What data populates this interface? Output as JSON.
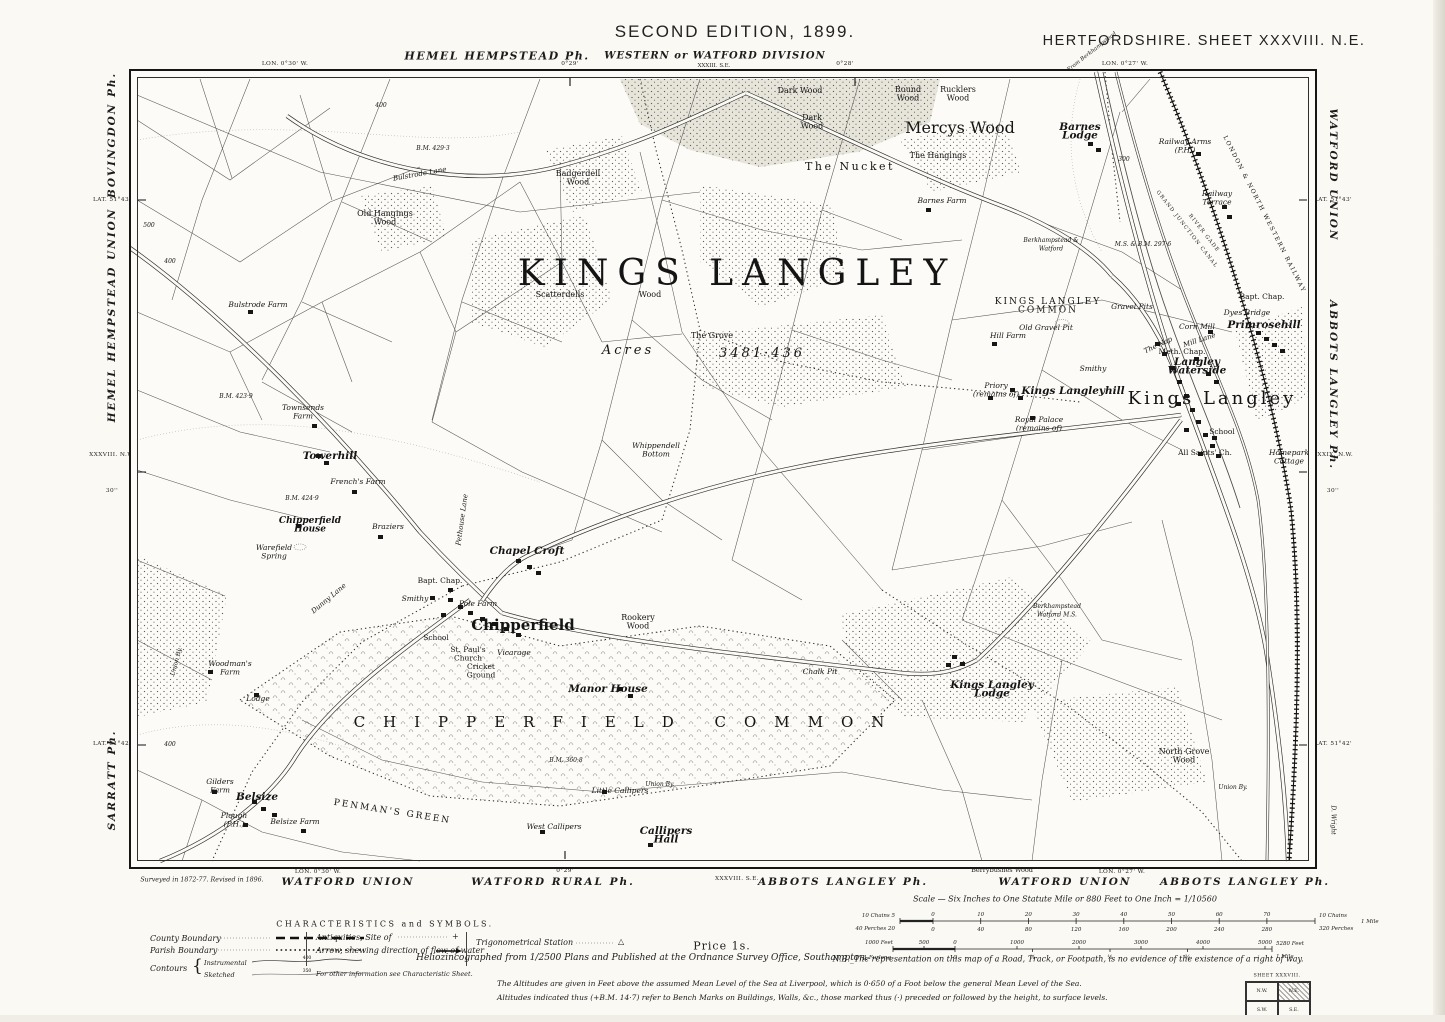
{
  "page": {
    "bg": "#faf9f4",
    "ink": "#1c1c1c"
  },
  "header": {
    "edition": "SECOND EDITION, 1899.",
    "sheet": "HERTFORDSHIRE.  SHEET XXXVIII. N.E.",
    "parish_top": "HEMEL HEMPSTEAD Ph.",
    "division": "WESTERN or WATFORD DIVISION",
    "division_sub": "XXXIII. S.E.",
    "from_note": "From Berkhampstead",
    "lon_marks": [
      {
        "text": "LON. 0°30' W.",
        "x": 285
      },
      {
        "text": "0°29'",
        "x": 570
      },
      {
        "text": "0°28'",
        "x": 845
      },
      {
        "text": "LON. 0°27' W.",
        "x": 1125
      }
    ]
  },
  "margin_left": [
    {
      "text": "BOVINGDON  Ph.",
      "y": 135,
      "cls": "par"
    },
    {
      "text": "LAT. 51°43'",
      "y": 200,
      "cls": "geo"
    },
    {
      "text": "HEMEL  HEMPSTEAD  UNION",
      "y": 315,
      "cls": "par"
    },
    {
      "text": "XXXVIII. N.W.",
      "y": 455,
      "cls": "geo"
    },
    {
      "text": "30''",
      "y": 491,
      "cls": "geo"
    },
    {
      "text": "LAT. 51°42'",
      "y": 744,
      "cls": "geo"
    },
    {
      "text": "SARRATT  Ph.",
      "y": 780,
      "cls": "par"
    }
  ],
  "margin_right": [
    {
      "text": "WATFORD  UNION",
      "y": 175,
      "cls": "par"
    },
    {
      "text": "LAT. 51°43'",
      "y": 200,
      "cls": "geo"
    },
    {
      "text": "ABBOTS  LANGLEY  Ph.",
      "y": 385,
      "cls": "par"
    },
    {
      "text": "XXXIX. N.W.",
      "y": 455,
      "cls": "geo"
    },
    {
      "text": "30''",
      "y": 491,
      "cls": "geo"
    },
    {
      "text": "D. Wright",
      "y": 820,
      "cls": "eng"
    },
    {
      "text": "LAT. 51°42'",
      "y": 744,
      "cls": "geo"
    }
  ],
  "margin_bottom": [
    {
      "text": "Surveyed in 1872-77.  Revised in 1896.",
      "x": 202,
      "y": 880,
      "cls": "tiny-i"
    },
    {
      "text": "LON. 0°30' W.",
      "x": 318,
      "y": 872,
      "cls": "geo"
    },
    {
      "text": "WATFORD  UNION",
      "x": 348,
      "y": 882,
      "cls": "par"
    },
    {
      "text": "0°29'",
      "x": 565,
      "y": 871,
      "cls": "geo"
    },
    {
      "text": "WATFORD  RURAL  Ph.",
      "x": 553,
      "y": 882,
      "cls": "par"
    },
    {
      "text": "XXXVIII. S.E.",
      "x": 737,
      "y": 879,
      "cls": "geo"
    },
    {
      "text": "ABBOTS  LANGLEY  Ph.",
      "x": 843,
      "y": 882,
      "cls": "par"
    },
    {
      "text": "Berrybushes  Wood",
      "x": 1002,
      "y": 870,
      "cls": "tiny-r"
    },
    {
      "text": "WATFORD  UNION",
      "x": 1065,
      "y": 882,
      "cls": "par"
    },
    {
      "text": "LON. 0°27' W.",
      "x": 1122,
      "y": 872,
      "cls": "geo"
    },
    {
      "text": "ABBOTS  LANGLEY  Ph.",
      "x": 1245,
      "y": 882,
      "cls": "par"
    }
  ],
  "map_labels": [
    {
      "t": "KINGS   LANGLEY",
      "x": 737,
      "y": 285,
      "c": "huge"
    },
    {
      "t": "Acres",
      "x": 628,
      "y": 354,
      "c": "acres"
    },
    {
      "t": "3481·436",
      "x": 762,
      "y": 357,
      "c": "acres"
    },
    {
      "t": "Scatterdells",
      "x": 560,
      "y": 297,
      "c": "wood"
    },
    {
      "t": "Wood",
      "x": 650,
      "y": 297,
      "c": "wood"
    },
    {
      "t": "The Grove",
      "x": 712,
      "y": 338,
      "c": "wood"
    },
    {
      "t": "Dark Wood",
      "x": 800,
      "y": 93,
      "c": "wood"
    },
    {
      "t": "Dark",
      "t2": "Wood",
      "x": 812,
      "y": 120,
      "c": "wood"
    },
    {
      "t": "Round",
      "t2": "Wood",
      "x": 908,
      "y": 92,
      "c": "wood"
    },
    {
      "t": "Rucklers",
      "t2": "Wood",
      "x": 958,
      "y": 92,
      "c": "wood"
    },
    {
      "t": "Mercys Wood",
      "x": 960,
      "y": 133,
      "c": "w ood"
    },
    {
      "t": "The Hangings",
      "x": 938,
      "y": 158,
      "c": "wood"
    },
    {
      "t": "The  Nucket",
      "x": 850,
      "y": 170,
      "c": "wood-lg"
    },
    {
      "t": "Barnes",
      "t2": "Lodge",
      "x": 1080,
      "y": 130,
      "c": "hamlet"
    },
    {
      "t": "Barnes Farm",
      "x": 942,
      "y": 203,
      "c": "farm"
    },
    {
      "t": "Badgerdell",
      "t2": "Wood",
      "x": 578,
      "y": 176,
      "c": "wood"
    },
    {
      "t": "Bulstrode Lane",
      "x": 420,
      "y": 176,
      "c": "lane",
      "r": -10
    },
    {
      "t": "Old Hangings",
      "t2": "Wood",
      "x": 385,
      "y": 216,
      "c": "wood"
    },
    {
      "t": "Bulstrode Farm",
      "x": 258,
      "y": 307,
      "c": "farm"
    },
    {
      "t": "Townsends",
      "t2": "Farm",
      "x": 303,
      "y": 410,
      "c": "farm"
    },
    {
      "t": "Towerhill",
      "x": 330,
      "y": 459,
      "c": "hamlet"
    },
    {
      "t": "French's Farm",
      "x": 358,
      "y": 484,
      "c": "farm"
    },
    {
      "t": "Chipperfield",
      "t2": "House",
      "x": 310,
      "y": 523,
      "c": "hamlet-sm"
    },
    {
      "t": "Braziers",
      "x": 388,
      "y": 529,
      "c": "farm"
    },
    {
      "t": "Warefield",
      "t2": "Spring",
      "x": 274,
      "y": 550,
      "c": "farm"
    },
    {
      "t": "Chapel Croft",
      "x": 527,
      "y": 554,
      "c": "hamlet"
    },
    {
      "t": "Pethouse Lane",
      "x": 464,
      "y": 520,
      "c": "lane",
      "r": -82
    },
    {
      "t": "Bapt. Chap.",
      "x": 440,
      "y": 583,
      "c": "church"
    },
    {
      "t": "Smithy",
      "x": 415,
      "y": 601,
      "c": "farm"
    },
    {
      "t": "Pole Farm",
      "x": 478,
      "y": 606,
      "c": "farm"
    },
    {
      "t": "Chipperfield",
      "x": 523,
      "y": 630,
      "c": "town2"
    },
    {
      "t": "School",
      "x": 436,
      "y": 640,
      "c": "church"
    },
    {
      "t": "St. Paul's",
      "t2": "Church",
      "x": 468,
      "y": 652,
      "c": "church"
    },
    {
      "t": "Vicarage",
      "x": 514,
      "y": 655,
      "c": "farm"
    },
    {
      "t": "Cricket",
      "t2": "Ground",
      "x": 481,
      "y": 669,
      "c": "church"
    },
    {
      "t": "Dunny Lane",
      "x": 330,
      "y": 600,
      "c": "lane",
      "r": -40
    },
    {
      "t": "Manor House",
      "x": 608,
      "y": 692,
      "c": "hamlet"
    },
    {
      "t": "CHIPPERFIELD COMMON",
      "x": 628,
      "y": 727,
      "c": "common-lg"
    },
    {
      "t": "Lodge",
      "x": 258,
      "y": 701,
      "c": "farm"
    },
    {
      "t": "Woodman's",
      "t2": "Farm",
      "x": 230,
      "y": 666,
      "c": "farm"
    },
    {
      "t": "Union By.",
      "x": 178,
      "y": 662,
      "c": "tiny",
      "r": -75
    },
    {
      "t": "Belsize",
      "x": 257,
      "y": 800,
      "c": "hamlet"
    },
    {
      "t": "Gilders",
      "t2": "Farm",
      "x": 220,
      "y": 784,
      "c": "farm"
    },
    {
      "t": "Plough",
      "t2": "(P.H.)",
      "x": 234,
      "y": 818,
      "c": "farm"
    },
    {
      "t": "Belsize Farm",
      "x": 295,
      "y": 824,
      "c": "farm"
    },
    {
      "t": "PENMAN'S  GREEN",
      "x": 392,
      "y": 814,
      "c": "common-sm",
      "r": 9
    },
    {
      "t": "Little Callipers",
      "x": 620,
      "y": 793,
      "c": "farm"
    },
    {
      "t": "Union By.",
      "x": 660,
      "y": 786,
      "c": "tiny"
    },
    {
      "t": "West Callipers",
      "x": 554,
      "y": 829,
      "c": "farm"
    },
    {
      "t": "Callipers",
      "t2": "Hall",
      "x": 666,
      "y": 834,
      "c": "hamlet"
    },
    {
      "t": "Rookery",
      "t2": "Wood",
      "x": 638,
      "y": 620,
      "c": "wood"
    },
    {
      "t": "Whippendell",
      "t2": "Bottom",
      "x": 656,
      "y": 448,
      "c": "farm"
    },
    {
      "t": "Chalk Pit",
      "x": 820,
      "y": 674,
      "c": "farm"
    },
    {
      "t": "Kings Langley",
      "t2": "Lodge",
      "x": 992,
      "y": 688,
      "c": "hamlet"
    },
    {
      "t": "KINGS LANGLEY",
      "t2": "COMMON",
      "x": 1048,
      "y": 304,
      "c": "common-sm"
    },
    {
      "t": "Old Gravel Pit",
      "x": 1046,
      "y": 330,
      "c": "farm"
    },
    {
      "t": "Hill Farm",
      "x": 1008,
      "y": 338,
      "c": "farm"
    },
    {
      "t": "Gravel Pits",
      "x": 1132,
      "y": 309,
      "c": "farm"
    },
    {
      "t": "Smithy",
      "x": 1093,
      "y": 371,
      "c": "farm"
    },
    {
      "t": "The Nap",
      "x": 1159,
      "y": 347,
      "c": "lane",
      "r": -25
    },
    {
      "t": "Meth. Chap.",
      "x": 1182,
      "y": 354,
      "c": "church"
    },
    {
      "t": "Langley",
      "t2": "Waterside",
      "x": 1197,
      "y": 365,
      "c": "hamlet"
    },
    {
      "t": "Corn Mill",
      "x": 1197,
      "y": 329,
      "c": "farm"
    },
    {
      "t": "Mill Lane",
      "x": 1200,
      "y": 342,
      "c": "lane",
      "r": -18
    },
    {
      "t": "Primrosehill",
      "x": 1264,
      "y": 328,
      "c": "hamlet"
    },
    {
      "t": "Dyes Bridge",
      "x": 1247,
      "y": 315,
      "c": "farm"
    },
    {
      "t": "Bapt. Chap.",
      "x": 1262,
      "y": 299,
      "c": "church"
    },
    {
      "t": "Kings Langleyhill",
      "x": 1073,
      "y": 394,
      "c": "hamlet"
    },
    {
      "t": "Kings Langley",
      "x": 1212,
      "y": 404,
      "c": "town"
    },
    {
      "t": "Priory",
      "t2": "(remains of)",
      "x": 996,
      "y": 388,
      "c": "farm"
    },
    {
      "t": "Royal Palace",
      "t2": "(remains of)",
      "x": 1039,
      "y": 422,
      "c": "farm"
    },
    {
      "t": "School",
      "x": 1222,
      "y": 434,
      "c": "church"
    },
    {
      "t": "All Saints' Ch.",
      "x": 1205,
      "y": 455,
      "c": "church"
    },
    {
      "t": "Homepark",
      "t2": "Cottage",
      "x": 1289,
      "y": 455,
      "c": "farm"
    },
    {
      "t": "Railway Arms",
      "t2": "(P.H.)",
      "x": 1185,
      "y": 144,
      "c": "farm"
    },
    {
      "t": "Railway",
      "t2": "Terrace",
      "x": 1217,
      "y": 196,
      "c": "farm"
    },
    {
      "t": "LONDON & NORTH WESTERN RAILWAY",
      "x": 1263,
      "y": 215,
      "c": "rail",
      "r": 63
    },
    {
      "t": "GRAND JUNCTION CANAL",
      "x": 1186,
      "y": 230,
      "c": "canal-t",
      "r": 52
    },
    {
      "t": "RIVER GADE",
      "x": 1203,
      "y": 234,
      "c": "canal-t",
      "r": 52
    },
    {
      "t": "North Grove",
      "t2": "Wood",
      "x": 1184,
      "y": 754,
      "c": "wood"
    },
    {
      "t": "Union By.",
      "x": 1233,
      "y": 789,
      "c": "tiny"
    },
    {
      "t": "Berkhampstead &",
      "t2": "Watford",
      "x": 1051,
      "y": 242,
      "c": "tiny"
    },
    {
      "t": "Berkhampstead",
      "t2": "Watford  M.S.",
      "x": 1057,
      "y": 608,
      "c": "tiny"
    },
    {
      "t": "M.S. & B.M. 297·6",
      "x": 1143,
      "y": 246,
      "c": "tiny"
    },
    {
      "t": "B.M. 429·3",
      "x": 433,
      "y": 150,
      "c": "tiny"
    },
    {
      "t": "B.M. 423·9",
      "x": 236,
      "y": 398,
      "c": "tiny"
    },
    {
      "t": "B.M. 424·9",
      "x": 302,
      "y": 500,
      "c": "tiny"
    },
    {
      "t": "B.M. 360·8",
      "x": 566,
      "y": 762,
      "c": "tiny"
    },
    {
      "t": "400",
      "x": 381,
      "y": 107,
      "c": "tiny"
    },
    {
      "t": "500",
      "x": 149,
      "y": 227,
      "c": "tiny"
    },
    {
      "t": "400",
      "x": 170,
      "y": 263,
      "c": "tiny"
    },
    {
      "t": "300",
      "x": 1124,
      "y": 161,
      "c": "tiny"
    },
    {
      "t": "400",
      "x": 170,
      "y": 746,
      "c": "tiny"
    }
  ],
  "legend": {
    "title": "CHARACTERISTICS  and  SYMBOLS.",
    "county": "County Boundary",
    "parish": "Parish Boundary",
    "contours": "Contours",
    "instrumental": "Instrumental",
    "sketched": "Sketched",
    "contour_val_1": "400",
    "contour_val_2": "350",
    "antiquities": "Antiquities, Site of",
    "antiquities_sym": "+",
    "arrow": "Arrow, shewing direction of flow of water",
    "trig": "Trigonometrical Station",
    "trig_sym": "△",
    "other": "For other information see Characteristic Sheet."
  },
  "scale_bars": {
    "title": "Scale — Six Inches to One Statute Mile or 880 Feet to One Inch = 1/10560",
    "price": "Price 1s.",
    "chains_left": "10 Chains 5",
    "chains_ticks": [
      "0",
      "10",
      "20",
      "30",
      "40",
      "50",
      "60",
      "70"
    ],
    "chains_right": "10 Chains",
    "perches_left": "40 Perches 20",
    "perches_ticks": [
      "0",
      "40",
      "80",
      "120",
      "160",
      "200",
      "240",
      "280"
    ],
    "perches_right": "320 Perches",
    "mile_right": "1 Mile",
    "feet_left_1000": "1000 Feet",
    "feet_left_500": "500",
    "feet_ticks": [
      "0",
      "1000",
      "2000",
      "3000",
      "4000",
      "5000"
    ],
    "feet_right": "5280 Feet",
    "furlong_left": "1 Furlong",
    "furlong_zero": "0",
    "furlong_ticks": [
      "¼",
      "½",
      "¾"
    ],
    "furlong_right": "1 Mile"
  },
  "imprint": {
    "helio": "Heliozincographed from 1/2500 Plans and Published at the Ordnance Survey Office, Southampton.",
    "nb": "N.B._The representation on this map of a Road, Track, or Footpath, is no evidence of the existence of a right of way.",
    "alt1": "The Altitudes are given in Feet above the assumed Mean Level of the Sea at Liverpool, which is 0·650 of a Foot below the general Mean Level of the Sea.",
    "alt2": "Altitudes indicated thus (+B.M. 14·7) refer to Bench Marks on Buildings, Walls, &c., those marked thus (·) preceded or followed by the height, to surface levels."
  },
  "sheet_index": {
    "title": "SHEET XXXVIII.",
    "cells": [
      "N.W.",
      "N.E.",
      "S.W.",
      "S.E."
    ],
    "highlight": "N.E."
  }
}
